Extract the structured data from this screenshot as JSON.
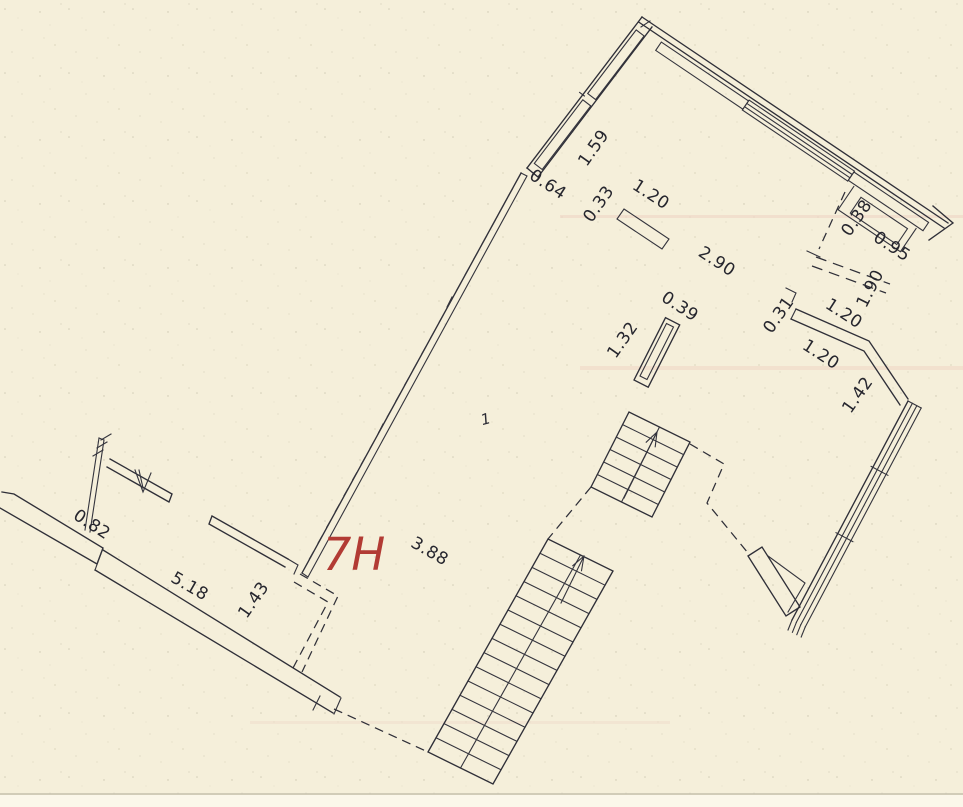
{
  "page": {
    "kind": "scanned architectural floor plan",
    "colors": {
      "paper": "#f5efda",
      "ink": "#2f2f38",
      "accent_red": "#b23b34"
    }
  },
  "plan": {
    "unit_label": {
      "text": "7H",
      "color": "#b23b34"
    },
    "room_number": "1",
    "dimension_labels": [
      {
        "text": "0.64",
        "x": 545,
        "y": 189,
        "rot": 33
      },
      {
        "text": "1.59",
        "x": 598,
        "y": 151,
        "rot": -55
      },
      {
        "text": "0.33",
        "x": 603,
        "y": 207,
        "rot": -55
      },
      {
        "text": "1.20",
        "x": 648,
        "y": 199,
        "rot": 33
      },
      {
        "text": "2.90",
        "x": 714,
        "y": 266,
        "rot": 33
      },
      {
        "text": "0.38",
        "x": 861,
        "y": 221,
        "rot": -55
      },
      {
        "text": "0.95",
        "x": 889,
        "y": 251,
        "rot": 33
      },
      {
        "text": "1.90",
        "x": 875,
        "y": 291,
        "rot": -63
      },
      {
        "text": "0.31",
        "x": 783,
        "y": 318,
        "rot": -55
      },
      {
        "text": "1.20",
        "x": 841,
        "y": 318,
        "rot": 33
      },
      {
        "text": "1.20",
        "x": 818,
        "y": 359,
        "rot": 33
      },
      {
        "text": "1.42",
        "x": 862,
        "y": 398,
        "rot": -55
      },
      {
        "text": "0.39",
        "x": 677,
        "y": 311,
        "rot": 33
      },
      {
        "text": "1.32",
        "x": 627,
        "y": 343,
        "rot": -55
      },
      {
        "text": "3.88",
        "x": 427,
        "y": 556,
        "rot": 30
      },
      {
        "text": "5.18",
        "x": 187,
        "y": 591,
        "rot": 30
      },
      {
        "text": "1.43",
        "x": 258,
        "y": 603,
        "rot": -55
      },
      {
        "text": "0.82",
        "x": 89,
        "y": 529,
        "rot": 33
      }
    ]
  }
}
